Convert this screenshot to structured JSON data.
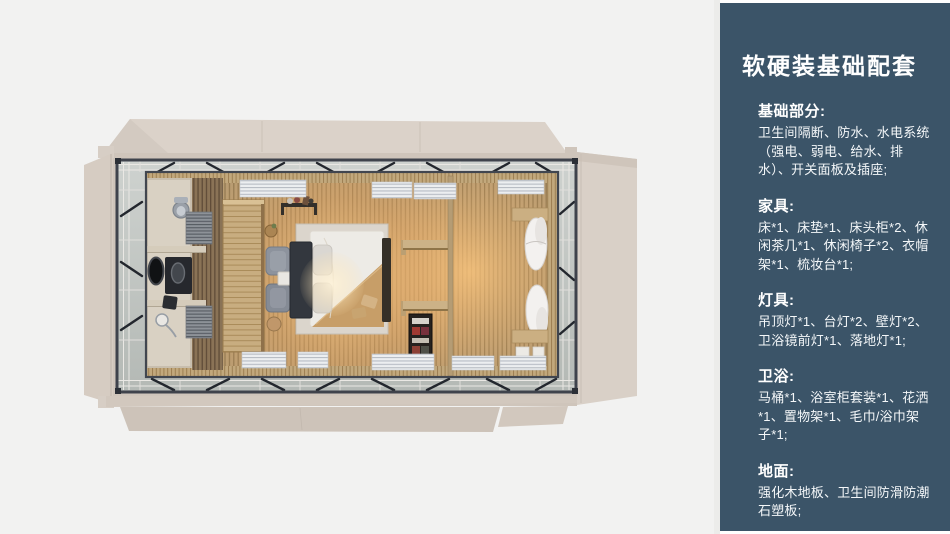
{
  "panel": {
    "title": "软硬装基础配套",
    "sections": [
      {
        "heading": "基础部分:",
        "body": "卫生间隔断、防水、水电系统（强电、弱电、给水、排水）、开关面板及插座;"
      },
      {
        "heading": "家具:",
        "body": "床*1、床垫*1、床头柜*2、休闲茶几*1、休闲椅子*2、衣帽架*1、梳妆台*1;"
      },
      {
        "heading": "灯具:",
        "body": "吊顶灯*1、台灯*2、壁灯*2、卫浴镜前灯*1、落地灯*1;"
      },
      {
        "heading": "卫浴:",
        "body": "马桶*1、浴室柜套装*1、花洒*1、置物架*1、毛巾/浴巾架子*1;"
      },
      {
        "heading": "地面:",
        "body": "强化木地板、卫生间防滑防潮石塑板;"
      }
    ]
  },
  "floorplan": {
    "description": "top-down render of prefab container suite with unfolded side panels",
    "rooms": [
      "bathroom",
      "bedroom",
      "lounge"
    ],
    "colors": {
      "panel_bg": "#3b5468",
      "panel_text": "#ffffff",
      "canvas_bg": "#f2f2f1",
      "flap_beige": "#d8cfc6",
      "floor_wood": "#b89c72",
      "warm_glow": "#eab36c",
      "steel_frame": "#3f434c",
      "bed_duvet": "#edebe6",
      "bed_headboard": "#33373e"
    }
  }
}
